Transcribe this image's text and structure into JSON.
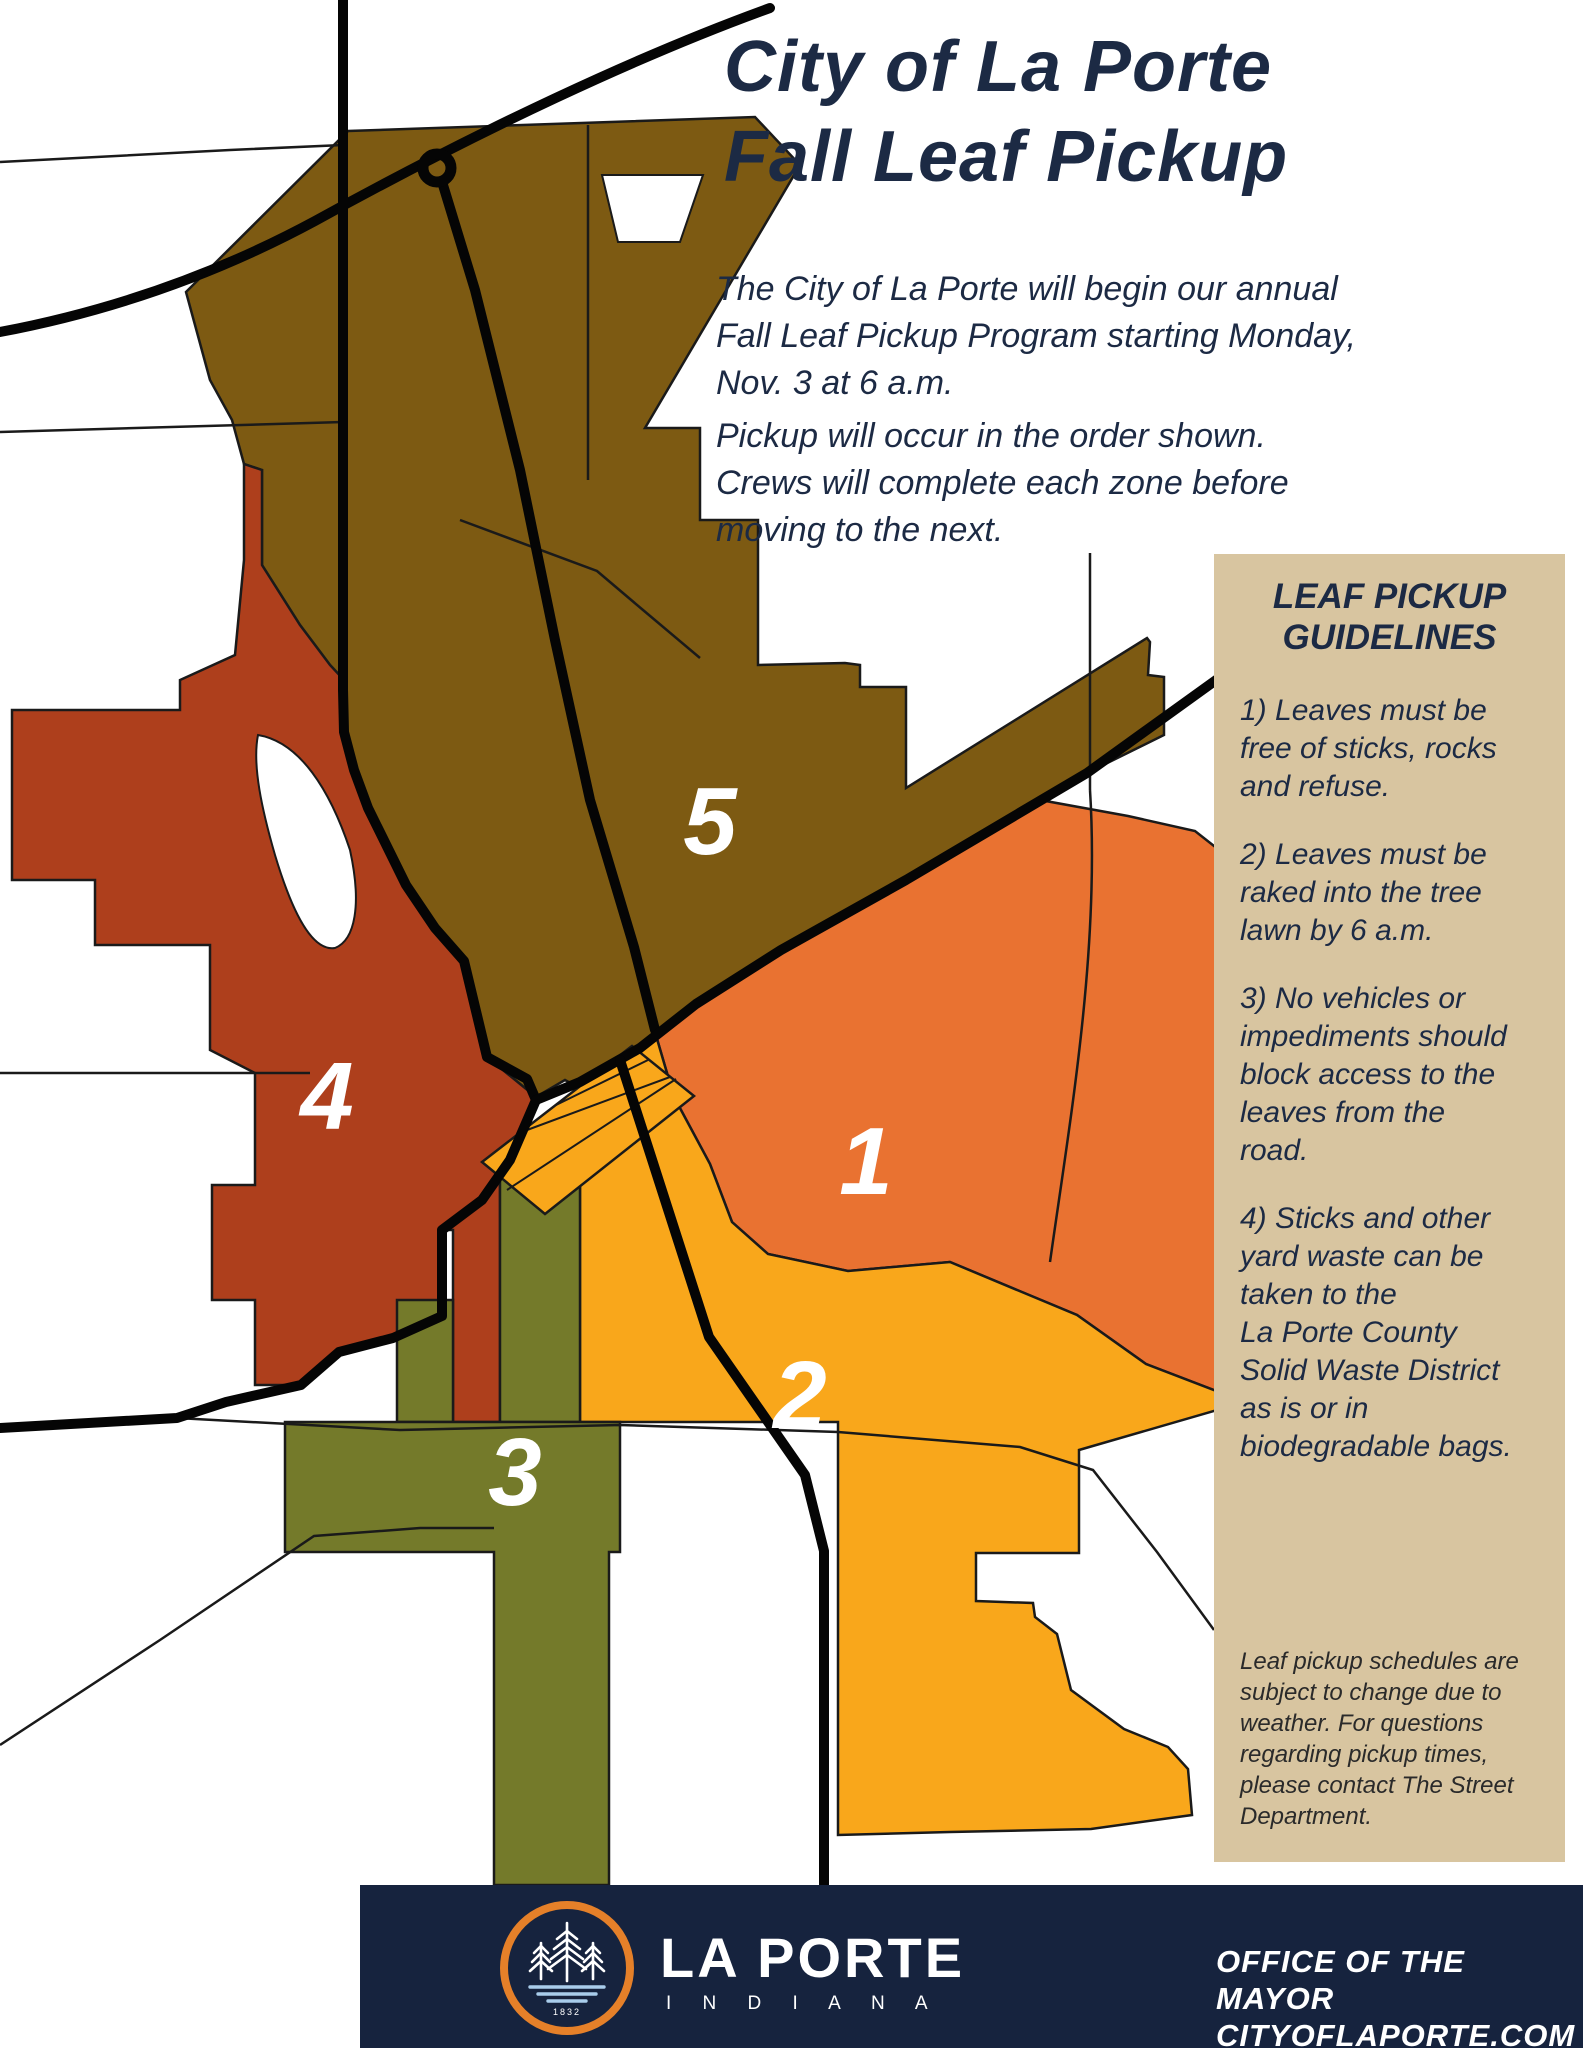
{
  "title": "City of La Porte\nFall Leaf Pickup",
  "intro": {
    "p1": "The City of La Porte will begin our annual\nFall Leaf Pickup Program starting Monday,\nNov. 3 at 6 a.m.",
    "p2": "Pickup will occur in the order shown.\nCrews will complete each zone before\nmoving to the next."
  },
  "guidelines": {
    "heading": "LEAF PICKUP\nGUIDELINES",
    "items": [
      "1) Leaves must be\nfree of sticks, rocks\nand refuse.",
      "2) Leaves must be\nraked into the tree\nlawn by 6 a.m.",
      "3) No vehicles or\nimpediments should\nblock access to the\nleaves from the\nroad.",
      "4) Sticks and other\nyard waste can be\ntaken to the\nLa Porte County\nSolid Waste District\nas is or in\nbiodegradable bags."
    ],
    "footnote": "Leaf pickup schedules are\nsubject to change due to\nweather. For questions\nregarding pickup times,\nplease contact The Street\nDepartment.",
    "panel_color": "#D8C5A0"
  },
  "map": {
    "zones": [
      {
        "number": "1",
        "color": "#E97231"
      },
      {
        "number": "2",
        "color": "#F9A71B"
      },
      {
        "number": "3",
        "color": "#747A2A"
      },
      {
        "number": "4",
        "color": "#AE3F1C"
      },
      {
        "number": "5",
        "color": "#7D5A12"
      }
    ],
    "road_color": "#050505",
    "text_color": "#1C2A44"
  },
  "footer": {
    "brand": "LA PORTE",
    "brand_sub": "I N D I A N A",
    "logo_year": "1832",
    "office_line1": "OFFICE OF THE MAYOR",
    "office_line2": "CITYOFLAPORTE.COM",
    "bar_color": "#16233E",
    "ring_color": "#E58029"
  }
}
